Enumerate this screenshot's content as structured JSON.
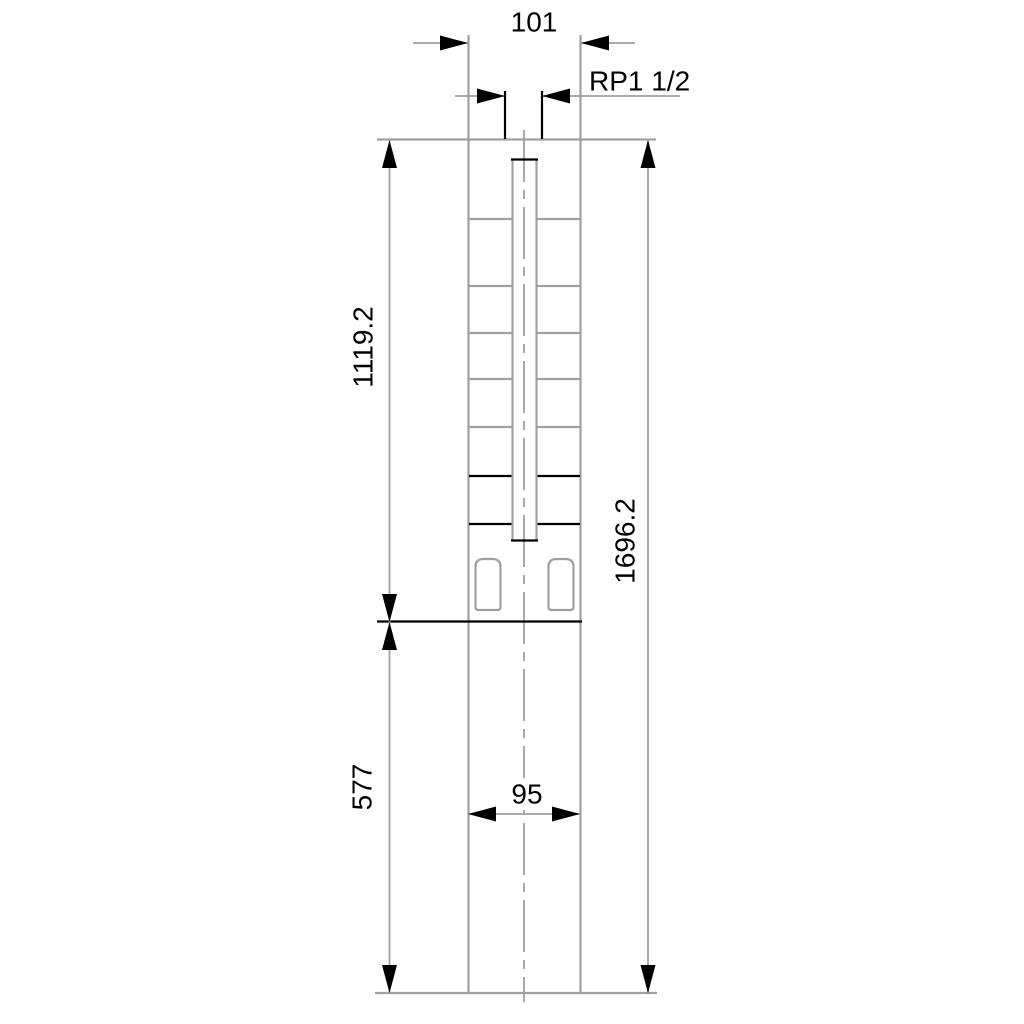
{
  "drawing": {
    "dims": {
      "top_width": "101",
      "thread": "RP1 1/2",
      "pump_length": "1119.2",
      "total_length": "1696.2",
      "motor_length": "577",
      "motor_width": "95"
    },
    "colors": {
      "line": "#a0a0a0",
      "feature": "#000000",
      "text": "#000000",
      "bg": "#ffffff"
    }
  }
}
